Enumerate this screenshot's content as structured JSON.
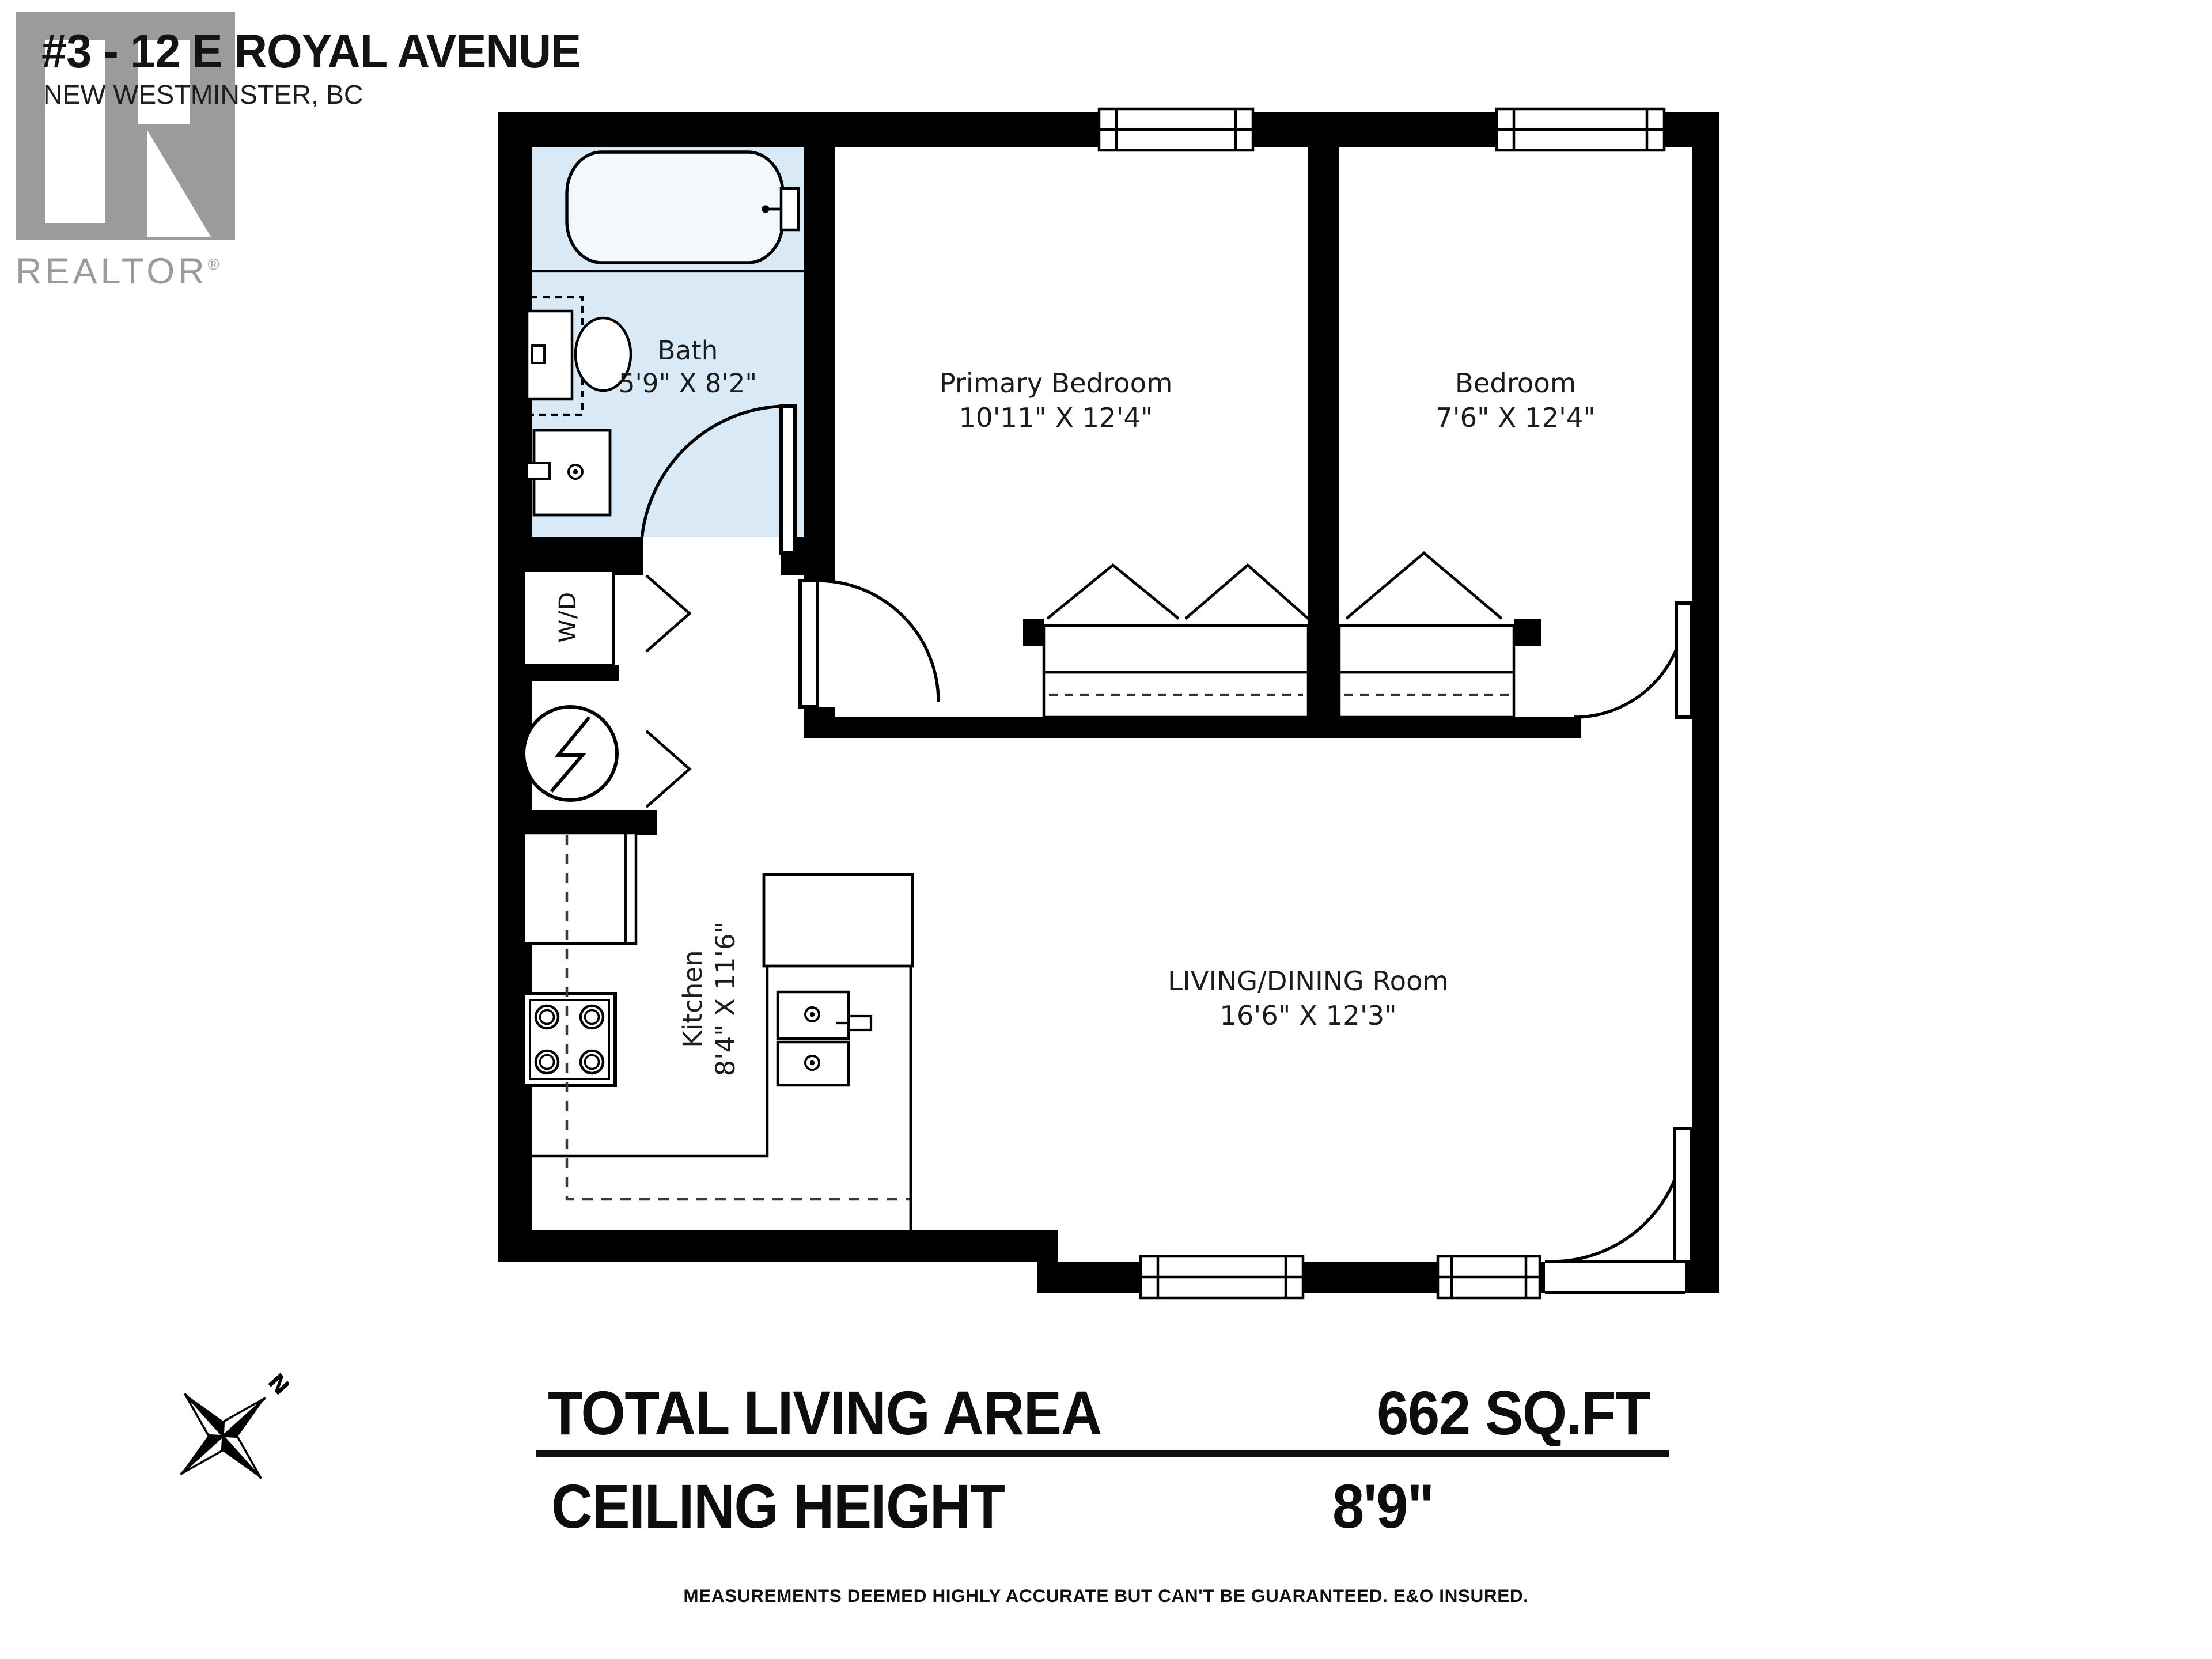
{
  "header": {
    "title": "#3 - 12 E ROYAL AVENUE",
    "subtitle": "NEW WESTMINSTER, BC",
    "logo": {
      "brand": "REALTOR",
      "reg": "®"
    }
  },
  "rooms": {
    "bath": {
      "name": "Bath",
      "dims": "5'9\" X 8'2\""
    },
    "primary": {
      "name": "Primary Bedroom",
      "dims": "10'11\" X 12'4\""
    },
    "bedroom": {
      "name": "Bedroom",
      "dims": "7'6\" X 12'4\""
    },
    "living": {
      "name": "LIVING/DINING Room",
      "dims": "16'6\" X 12'3\""
    },
    "kitchen": {
      "name": "Kitchen",
      "dims": "8'4\" X 11'6\""
    },
    "laundry": {
      "label": "W/D"
    }
  },
  "compass": {
    "north": "N"
  },
  "footer": {
    "total_label": "TOTAL LIVING AREA",
    "total_value": "662 SQ.FT",
    "ceiling_label": "CEILING HEIGHT",
    "ceiling_value": "8'9\"",
    "disclaimer": "MEASUREMENTS DEEMED HIGHLY ACCURATE BUT CAN'T BE GUARANTEED. E&O INSURED."
  },
  "colors": {
    "wall": "#000000",
    "bath_fill": "#d9eaf6",
    "logo_gray": "#9b9b9b",
    "text": "#1a1a1a"
  }
}
